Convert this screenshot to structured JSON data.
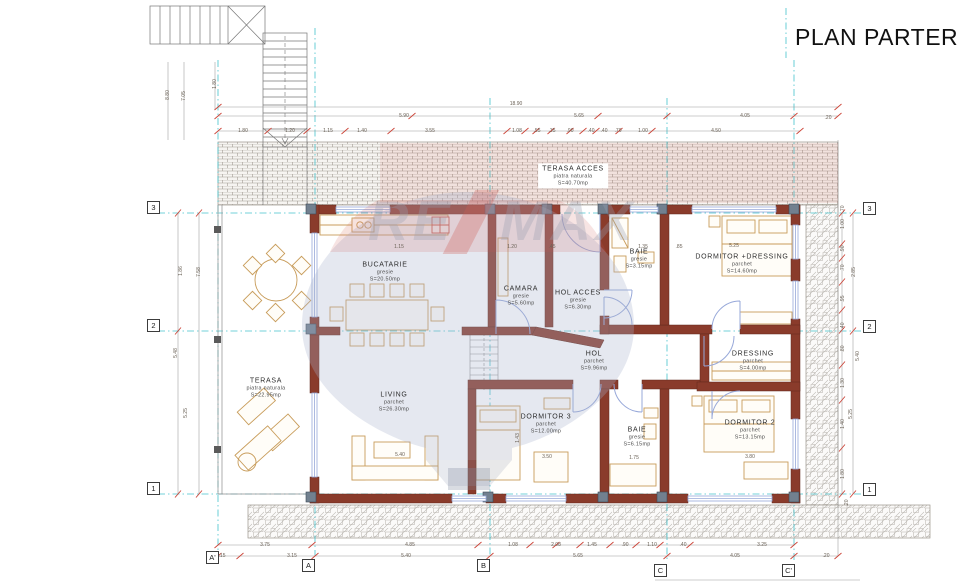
{
  "title": {
    "text": "PLAN PARTER"
  },
  "watermark": {
    "brand": "RE/MAX",
    "left": "RE",
    "right": "MAX"
  },
  "colors": {
    "wall": "#8a3b2b",
    "grid_teal": "#45c3cd",
    "dim_red": "#cc4438",
    "furniture": "#c89c5a",
    "window_blue": "#97a8d9",
    "hatch_gray": "#a09a92"
  },
  "rooms": [
    {
      "name": "TERASA ACCES",
      "finish": "piatra naturala",
      "area": "S=40.70mp",
      "x": 573,
      "y": 176,
      "boxed": true
    },
    {
      "name": "BUCATARIE",
      "finish": "gresie",
      "area": "S=20.50mp",
      "x": 385,
      "y": 272
    },
    {
      "name": "CAMARA",
      "finish": "gresie",
      "area": "S=5.60mp",
      "x": 521,
      "y": 296
    },
    {
      "name": "HOL ACCES",
      "finish": "gresie",
      "area": "S=6.30mp",
      "x": 578,
      "y": 300
    },
    {
      "name": "BAIE",
      "finish": "gresie",
      "area": "S=3.15mp",
      "x": 639,
      "y": 259
    },
    {
      "name": "DORMITOR +DRESSING",
      "finish": "parchet",
      "area": "S=14.60mp",
      "x": 742,
      "y": 264
    },
    {
      "name": "HOL",
      "finish": "parchet",
      "area": "S=9.96mp",
      "x": 594,
      "y": 361
    },
    {
      "name": "DRESSING",
      "finish": "parchet",
      "area": "S=4.00mp",
      "x": 753,
      "y": 361
    },
    {
      "name": "TERASA",
      "finish": "piatra naturala",
      "area": "S=22.95mp",
      "x": 266,
      "y": 388
    },
    {
      "name": "LIVING",
      "finish": "parchet",
      "area": "S=26.30mp",
      "x": 394,
      "y": 402
    },
    {
      "name": "DORMITOR 3",
      "finish": "parchet",
      "area": "S=12.00mp",
      "x": 546,
      "y": 424
    },
    {
      "name": "BAIE",
      "finish": "gresie",
      "area": "S=6.15mp",
      "x": 637,
      "y": 437
    },
    {
      "name": "DORMITOR 2",
      "finish": "parchet",
      "area": "S=13.15mp",
      "x": 750,
      "y": 430
    }
  ],
  "grid": {
    "rows": [
      {
        "label": "3",
        "x": 147,
        "y": 201
      },
      {
        "label": "2",
        "x": 147,
        "y": 319
      },
      {
        "label": "1",
        "x": 147,
        "y": 482
      },
      {
        "label": "3",
        "x": 863,
        "y": 202
      },
      {
        "label": "2",
        "x": 863,
        "y": 320
      },
      {
        "label": "1",
        "x": 863,
        "y": 483
      }
    ],
    "cols": [
      {
        "label": "A'",
        "x": 206,
        "y": 551
      },
      {
        "label": "A",
        "x": 302,
        "y": 559
      },
      {
        "label": "B",
        "x": 477,
        "y": 559
      },
      {
        "label": "C",
        "x": 654,
        "y": 564
      },
      {
        "label": "C'",
        "x": 782,
        "y": 564
      }
    ]
  },
  "dimension_labels": [
    {
      "t": "18.90",
      "x": 516,
      "y": 104
    },
    {
      "t": "5.90",
      "x": 404,
      "y": 116
    },
    {
      "t": "5.65",
      "x": 579,
      "y": 116
    },
    {
      "t": "4.05",
      "x": 745,
      "y": 116
    },
    {
      "t": ".20",
      "x": 828,
      "y": 118
    },
    {
      "t": "1.80",
      "x": 243,
      "y": 131
    },
    {
      "t": "1.20",
      "x": 290,
      "y": 131
    },
    {
      "t": "1.15",
      "x": 328,
      "y": 131
    },
    {
      "t": "1.40",
      "x": 362,
      "y": 131
    },
    {
      "t": "3.55",
      "x": 430,
      "y": 131
    },
    {
      "t": "1.08",
      "x": 517,
      "y": 131
    },
    {
      "t": ".55",
      "x": 537,
      "y": 131
    },
    {
      "t": ".35",
      "x": 552,
      "y": 131
    },
    {
      "t": ".90",
      "x": 570,
      "y": 131
    },
    {
      "t": ".40",
      "x": 591,
      "y": 131
    },
    {
      "t": ".40",
      "x": 604,
      "y": 131
    },
    {
      "t": ".70",
      "x": 618,
      "y": 131
    },
    {
      "t": "1.00",
      "x": 643,
      "y": 131
    },
    {
      "t": "4.50",
      "x": 716,
      "y": 131
    },
    {
      "t": "3.75",
      "x": 265,
      "y": 545
    },
    {
      "t": "4.85",
      "x": 410,
      "y": 545
    },
    {
      "t": "1.08",
      "x": 513,
      "y": 545
    },
    {
      "t": "2.08",
      "x": 556,
      "y": 545
    },
    {
      "t": "1.45",
      "x": 592,
      "y": 545
    },
    {
      "t": ".90",
      "x": 625,
      "y": 545
    },
    {
      "t": "1.10",
      "x": 652,
      "y": 545
    },
    {
      "t": ".40",
      "x": 683,
      "y": 545
    },
    {
      "t": "3.25",
      "x": 762,
      "y": 545
    },
    {
      "t": ".15",
      "x": 222,
      "y": 556
    },
    {
      "t": "3.15",
      "x": 292,
      "y": 556
    },
    {
      "t": "5.40",
      "x": 406,
      "y": 556
    },
    {
      "t": "5.65",
      "x": 578,
      "y": 556
    },
    {
      "t": "4.05",
      "x": 735,
      "y": 556
    },
    {
      "t": ".20",
      "x": 826,
      "y": 556
    },
    {
      "t": "8.80",
      "x": 168,
      "y": 95,
      "r": 1
    },
    {
      "t": "7.05",
      "x": 184,
      "y": 96,
      "r": 1
    },
    {
      "t": "1.80",
      "x": 215,
      "y": 84,
      "r": 1
    },
    {
      "t": "1.86",
      "x": 181,
      "y": 271,
      "r": 1
    },
    {
      "t": "7.58",
      "x": 199,
      "y": 272,
      "r": 1
    },
    {
      "t": "5.48",
      "x": 176,
      "y": 353,
      "r": 1
    },
    {
      "t": "5.25",
      "x": 186,
      "y": 413,
      "r": 1
    },
    {
      "t": ".70",
      "x": 843,
      "y": 209,
      "r": 1
    },
    {
      "t": "1.00",
      "x": 843,
      "y": 224,
      "r": 1
    },
    {
      "t": ".90",
      "x": 843,
      "y": 249,
      "r": 1
    },
    {
      "t": ".70",
      "x": 843,
      "y": 268,
      "r": 1
    },
    {
      "t": ".95",
      "x": 843,
      "y": 299,
      "r": 1
    },
    {
      "t": ".40",
      "x": 843,
      "y": 326,
      "r": 1
    },
    {
      "t": ".80",
      "x": 843,
      "y": 349,
      "r": 1
    },
    {
      "t": "1.30",
      "x": 843,
      "y": 383,
      "r": 1
    },
    {
      "t": "1.40",
      "x": 843,
      "y": 424,
      "r": 1
    },
    {
      "t": "1.80",
      "x": 843,
      "y": 474,
      "r": 1
    },
    {
      "t": "2.85",
      "x": 854,
      "y": 272,
      "r": 1
    },
    {
      "t": "5.40",
      "x": 858,
      "y": 356,
      "r": 1
    },
    {
      "t": "5.25",
      "x": 851,
      "y": 414,
      "r": 1
    },
    {
      "t": ".20",
      "x": 847,
      "y": 503,
      "r": 1
    },
    {
      "t": "1.15",
      "x": 399,
      "y": 247
    },
    {
      "t": "1.20",
      "x": 512,
      "y": 247
    },
    {
      "t": ".45",
      "x": 552,
      "y": 247
    },
    {
      "t": "1.35",
      "x": 643,
      "y": 247
    },
    {
      "t": ".85",
      "x": 679,
      "y": 247
    },
    {
      "t": "5.25",
      "x": 734,
      "y": 246
    },
    {
      "t": "5.40",
      "x": 400,
      "y": 455
    },
    {
      "t": "3.50",
      "x": 547,
      "y": 457
    },
    {
      "t": "1.75",
      "x": 634,
      "y": 458
    },
    {
      "t": "3.80",
      "x": 750,
      "y": 457
    },
    {
      "t": "1.43",
      "x": 518,
      "y": 438,
      "r": 1
    }
  ]
}
